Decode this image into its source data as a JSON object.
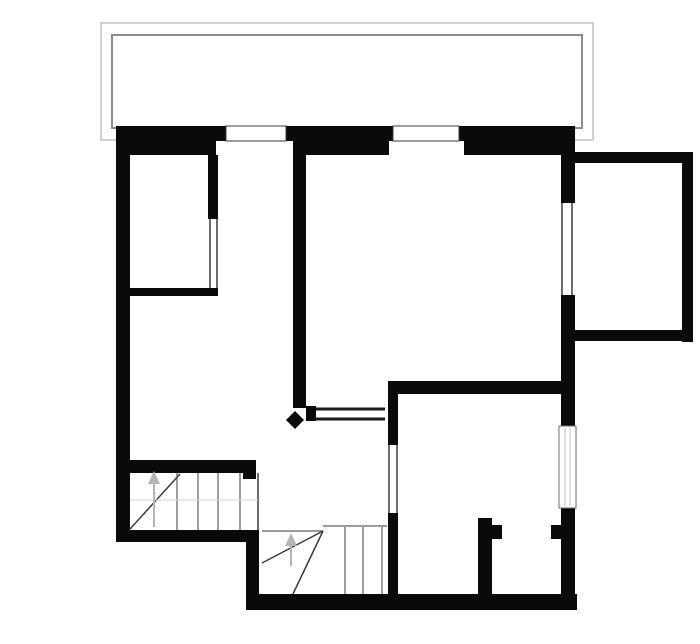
{
  "canvas": {
    "width": 700,
    "height": 644,
    "background": "#ffffff"
  },
  "colors": {
    "wall": "#0a0a0a",
    "floor": "#ffffff",
    "stair_line": "#3c3c3c",
    "stair_guide": "#7a7a7a",
    "faint_line": "#d5d5d5",
    "terrace_outer": "#c2c2c2",
    "terrace_inner": "#8d8d8d",
    "arrow": "#b5b5b5",
    "symbol_border": "#3c3c3c",
    "window_border": "#6f6f6f",
    "glazing": "#c0c0c0"
  },
  "rects": [
    {
      "name": "terrace-outer-outline",
      "x": 101,
      "y": 23,
      "w": 492,
      "h": 117,
      "fill": "none",
      "stroke": "#c2c2c2",
      "sw": 1.5
    },
    {
      "name": "terrace-inner-outline",
      "x": 112,
      "y": 35,
      "w": 470,
      "h": 93,
      "fill": "none",
      "stroke": "#8d8d8d",
      "sw": 2
    },
    {
      "name": "top-wall-upper-left",
      "x": 116,
      "y": 126,
      "w": 110,
      "h": 15,
      "fill": "#0a0a0a"
    },
    {
      "name": "top-wall-upper-mid",
      "x": 286,
      "y": 126,
      "w": 107,
      "h": 15,
      "fill": "#0a0a0a"
    },
    {
      "name": "top-wall-upper-right",
      "x": 459,
      "y": 126,
      "w": 116,
      "h": 15,
      "fill": "#0a0a0a"
    },
    {
      "name": "top-wall-lower-left",
      "x": 116,
      "y": 141,
      "w": 100,
      "h": 14,
      "fill": "#0a0a0a"
    },
    {
      "name": "top-wall-lower-mid",
      "x": 293,
      "y": 141,
      "w": 96,
      "h": 14,
      "fill": "#0a0a0a"
    },
    {
      "name": "top-wall-lower-right",
      "x": 464,
      "y": 141,
      "w": 111,
      "h": 14,
      "fill": "#0a0a0a"
    },
    {
      "name": "left-exterior-wall",
      "x": 116,
      "y": 141,
      "w": 14,
      "h": 401,
      "fill": "#0a0a0a"
    },
    {
      "name": "upperleft-room-right-wall",
      "x": 208,
      "y": 155,
      "w": 10,
      "h": 64,
      "fill": "#0a0a0a"
    },
    {
      "name": "upperleft-room-bottom-wall",
      "x": 116,
      "y": 288,
      "w": 102,
      "h": 8,
      "fill": "#0a0a0a"
    },
    {
      "name": "central-partition-wall",
      "x": 293,
      "y": 155,
      "w": 13,
      "h": 253,
      "fill": "#0a0a0a"
    },
    {
      "name": "central-wall-end-cap",
      "x": 306,
      "y": 406,
      "w": 10,
      "h": 15,
      "fill": "#0a0a0a"
    },
    {
      "name": "right-exterior-wall-top",
      "x": 561,
      "y": 141,
      "w": 14,
      "h": 62,
      "fill": "#0a0a0a"
    },
    {
      "name": "right-exterior-wall-mid",
      "x": 561,
      "y": 295,
      "w": 14,
      "h": 133,
      "fill": "#0a0a0a"
    },
    {
      "name": "right-exterior-wall-bottom",
      "x": 561,
      "y": 508,
      "w": 14,
      "h": 102,
      "fill": "#0a0a0a"
    },
    {
      "name": "bottomright-room-top-wall",
      "x": 388,
      "y": 381,
      "w": 187,
      "h": 13,
      "fill": "#0a0a0a"
    },
    {
      "name": "bottomright-room-left-wall-upper",
      "x": 388,
      "y": 381,
      "w": 10,
      "h": 64,
      "fill": "#0a0a0a"
    },
    {
      "name": "bottomright-room-left-wall-lower",
      "x": 388,
      "y": 513,
      "w": 10,
      "h": 97,
      "fill": "#0a0a0a"
    },
    {
      "name": "stair-top-wall",
      "x": 116,
      "y": 460,
      "w": 140,
      "h": 13,
      "fill": "#0a0a0a"
    },
    {
      "name": "stair-top-wall-cap",
      "x": 243,
      "y": 460,
      "w": 13,
      "h": 19,
      "fill": "#0a0a0a"
    },
    {
      "name": "stair-bottom-wall",
      "x": 116,
      "y": 530,
      "w": 143,
      "h": 12,
      "fill": "#0a0a0a"
    },
    {
      "name": "lowerleft-vertical-wall",
      "x": 246,
      "y": 530,
      "w": 13,
      "h": 80,
      "fill": "#0a0a0a"
    },
    {
      "name": "bottom-exterior-wall",
      "x": 246,
      "y": 594,
      "w": 331,
      "h": 16,
      "fill": "#0a0a0a"
    },
    {
      "name": "closet-partition-wall",
      "x": 478,
      "y": 518,
      "w": 14,
      "h": 78,
      "fill": "#0a0a0a"
    },
    {
      "name": "closet-door-jamb-left",
      "x": 492,
      "y": 525,
      "w": 10,
      "h": 14,
      "fill": "#0a0a0a"
    },
    {
      "name": "closet-door-jamb-right",
      "x": 551,
      "y": 525,
      "w": 10,
      "h": 14,
      "fill": "#0a0a0a"
    },
    {
      "name": "extension-room-top-wall",
      "x": 575,
      "y": 152,
      "w": 118,
      "h": 11,
      "fill": "#0a0a0a"
    },
    {
      "name": "extension-room-right-wall",
      "x": 682,
      "y": 152,
      "w": 11,
      "h": 190,
      "fill": "#0a0a0a"
    },
    {
      "name": "extension-room-bottom-wall",
      "x": 575,
      "y": 330,
      "w": 118,
      "h": 11,
      "fill": "#0a0a0a"
    },
    {
      "name": "terrace-door-symbol-left",
      "x": 226,
      "y": 126,
      "w": 60,
      "h": 15,
      "fill": "#ffffff",
      "stroke": "#3c3c3c",
      "sw": 1
    },
    {
      "name": "terrace-door-symbol-right",
      "x": 393,
      "y": 126,
      "w": 66,
      "h": 15,
      "fill": "#ffffff",
      "stroke": "#3c3c3c",
      "sw": 1
    },
    {
      "name": "right-wall-window-upper",
      "x": 561,
      "y": 203,
      "w": 14,
      "h": 92,
      "fill": "#ffffff"
    },
    {
      "name": "right-wall-window-lower",
      "x": 559,
      "y": 426,
      "w": 17,
      "h": 82,
      "fill": "#ffffff",
      "stroke": "#6f6f6f",
      "sw": 1
    }
  ],
  "lines": [
    {
      "name": "window-upper-glass-line-outer",
      "x1": 562,
      "y1": 203,
      "x2": 562,
      "y2": 295,
      "stroke": "#3c3c3c",
      "w": 1.5
    },
    {
      "name": "window-upper-glass-line-inner",
      "x1": 572,
      "y1": 203,
      "x2": 572,
      "y2": 295,
      "stroke": "#3c3c3c",
      "w": 1.5
    },
    {
      "name": "window-lower-glazing-line-1",
      "x1": 565,
      "y1": 428,
      "x2": 565,
      "y2": 506,
      "stroke": "#c0c0c0",
      "w": 1
    },
    {
      "name": "window-lower-glazing-line-2",
      "x1": 570,
      "y1": 428,
      "x2": 570,
      "y2": 506,
      "stroke": "#c0c0c0",
      "w": 1
    },
    {
      "name": "upperleft-room-door-line-left",
      "x1": 210,
      "y1": 219,
      "x2": 210,
      "y2": 288,
      "stroke": "#3c3c3c",
      "w": 1.5
    },
    {
      "name": "upperleft-room-door-line-right",
      "x1": 217,
      "y1": 219,
      "x2": 217,
      "y2": 288,
      "stroke": "#3c3c3c",
      "w": 1.5
    },
    {
      "name": "bottomright-room-door-line-left",
      "x1": 389,
      "y1": 445,
      "x2": 389,
      "y2": 513,
      "stroke": "#3c3c3c",
      "w": 1.5
    },
    {
      "name": "bottomright-room-door-line-right",
      "x1": 397,
      "y1": 445,
      "x2": 397,
      "y2": 513,
      "stroke": "#3c3c3c",
      "w": 1.5
    },
    {
      "name": "hall-opening-line-top",
      "x1": 316,
      "y1": 409,
      "x2": 385,
      "y2": 409,
      "stroke": "#1a1a1a",
      "w": 3
    },
    {
      "name": "hall-opening-line-bottom",
      "x1": 316,
      "y1": 419,
      "x2": 385,
      "y2": 419,
      "stroke": "#1a1a1a",
      "w": 3
    },
    {
      "name": "upper-stair-tread-1",
      "x1": 177,
      "y1": 473,
      "x2": 177,
      "y2": 530,
      "stroke": "#3c3c3c",
      "w": 1
    },
    {
      "name": "upper-stair-tread-2",
      "x1": 198,
      "y1": 473,
      "x2": 198,
      "y2": 530,
      "stroke": "#3c3c3c",
      "w": 1
    },
    {
      "name": "upper-stair-tread-3",
      "x1": 218,
      "y1": 473,
      "x2": 218,
      "y2": 530,
      "stroke": "#3c3c3c",
      "w": 1
    },
    {
      "name": "upper-stair-tread-4",
      "x1": 240,
      "y1": 473,
      "x2": 240,
      "y2": 530,
      "stroke": "#3c3c3c",
      "w": 1
    },
    {
      "name": "upper-stair-edge",
      "x1": 258,
      "y1": 473,
      "x2": 258,
      "y2": 530,
      "stroke": "#3c3c3c",
      "w": 1.5
    },
    {
      "name": "upper-stair-diagonal",
      "x1": 130,
      "y1": 529,
      "x2": 180,
      "y2": 474,
      "stroke": "#3c3c3c",
      "w": 1.5
    },
    {
      "name": "upper-stair-faint-landing-line",
      "x1": 130,
      "y1": 500,
      "x2": 258,
      "y2": 500,
      "stroke": "#d5d5d5",
      "w": 1
    },
    {
      "name": "upper-stair-arrow-stem",
      "x1": 154,
      "y1": 481,
      "x2": 154,
      "y2": 527,
      "stroke": "#b5b5b5",
      "w": 2
    },
    {
      "name": "lower-stair-top-line",
      "x1": 323,
      "y1": 526,
      "x2": 387,
      "y2": 526,
      "stroke": "#7a7a7a",
      "w": 1.5
    },
    {
      "name": "lower-stair-left-line",
      "x1": 262,
      "y1": 531,
      "x2": 323,
      "y2": 531,
      "stroke": "#7a7a7a",
      "w": 1.5
    },
    {
      "name": "lower-stair-tread-1",
      "x1": 345,
      "y1": 527,
      "x2": 345,
      "y2": 594,
      "stroke": "#3c3c3c",
      "w": 1
    },
    {
      "name": "lower-stair-tread-2",
      "x1": 363,
      "y1": 527,
      "x2": 363,
      "y2": 594,
      "stroke": "#3c3c3c",
      "w": 1
    },
    {
      "name": "lower-stair-tread-3",
      "x1": 382,
      "y1": 527,
      "x2": 382,
      "y2": 594,
      "stroke": "#3c3c3c",
      "w": 1
    },
    {
      "name": "lower-stair-winder-1",
      "x1": 323,
      "y1": 531,
      "x2": 262,
      "y2": 563,
      "stroke": "#3c3c3c",
      "w": 1.5
    },
    {
      "name": "lower-stair-winder-2",
      "x1": 323,
      "y1": 531,
      "x2": 293,
      "y2": 594,
      "stroke": "#3c3c3c",
      "w": 1.5
    },
    {
      "name": "lower-stair-arrow-stem",
      "x1": 291,
      "y1": 542,
      "x2": 291,
      "y2": 566,
      "stroke": "#b5b5b5",
      "w": 2
    }
  ],
  "polygons": [
    {
      "name": "upper-stair-arrow-head",
      "points": "148,484 160,484 154,471",
      "fill": "#b5b5b5"
    },
    {
      "name": "lower-stair-arrow-head",
      "points": "285,546 297,546 291,533",
      "fill": "#b5b5b5"
    },
    {
      "name": "door-leaf-marker",
      "points": "295,411 304,420 295,429 286,420",
      "fill": "#0a0a0a"
    }
  ]
}
